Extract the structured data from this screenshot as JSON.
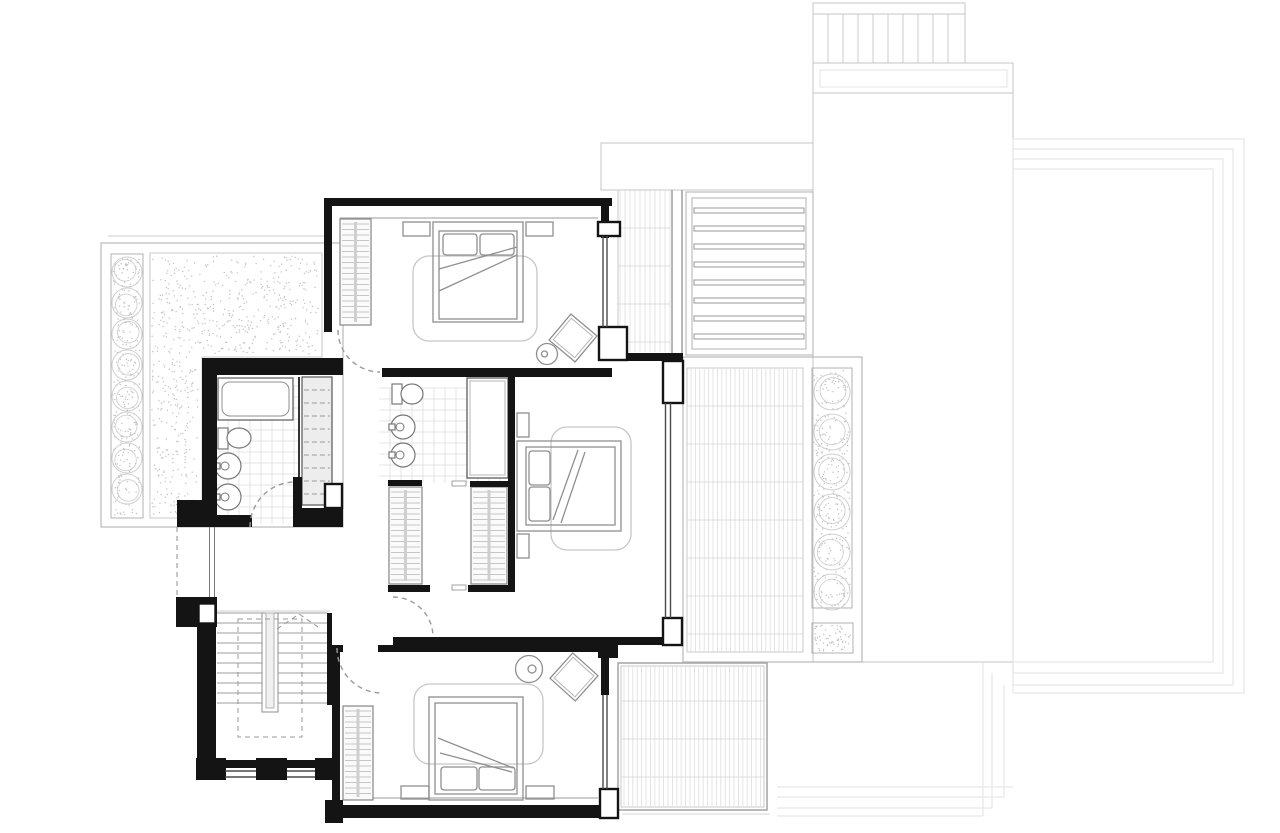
{
  "document": {
    "type": "architectural-floor-plan",
    "background": "#ffffff",
    "width": 1280,
    "height": 833
  },
  "palette": {
    "wall": "#141414",
    "pilaster_stroke": "#141414",
    "window": "#4a4a4a",
    "window_light": "#7a7a7a",
    "door_dash": "#9a9a9a",
    "furniture": "#8f8f8f",
    "furniture_inner": "#b5b5b5",
    "rug": "#c6c6c6",
    "ledge": "#9a9a9a",
    "hatch": "#b4b4b4",
    "spine": "#cfcfcf",
    "wardrobe_fill": "#fafafa",
    "cabinet_dash_fill": "#ededed",
    "tile_line": "#dedede",
    "tile_row": "#d4d4d4",
    "tile_border": "#a9a9a9",
    "tile_border_light": "#c9c9c9",
    "terrace_border": "#ababab",
    "outdoor": "#c6c6c6",
    "pool": "#e3e3e3",
    "stipple": "#c0c0c0",
    "bush": "#d0d0d0",
    "stair": "#9c9c9c",
    "stair_faint": "#cfcfcf",
    "beam": "#999999",
    "louver": "#b0b0b0"
  },
  "patterns": {
    "pergola_slats": 9,
    "pergola_slat_step": 15,
    "louver_slats": 8,
    "louver_slat_step": 18,
    "stair_treads": 10,
    "stair_tread_step": 10,
    "tile_step_fine": 4.4,
    "tile_step_strip": 5,
    "tile_row_step": 38,
    "bath_tile_step": 11,
    "wardrobe_hatch_step": 5.5,
    "cabinet_dash_step": 13,
    "bushes_left": 8,
    "bushes_right": 6,
    "pool_rings": 4,
    "dots_left_terrace": 430,
    "dots_left_side": 200,
    "dots_left_strip": 200,
    "dots_right_strip": 220,
    "dots_right_square": 60,
    "random_seed": 7
  },
  "components": {
    "rooms": [
      "bedroom-top",
      "master-suite",
      "ensuite-bathroom",
      "walk-in-closet",
      "bathroom",
      "hallway",
      "staircase",
      "bedroom-bottom"
    ],
    "outdoor": [
      "left-terrace",
      "right-terrace",
      "pool",
      "pool-deck",
      "pergola",
      "spa-bench",
      "louver-screen",
      "tiled-patio",
      "planting-strips"
    ],
    "furniture": [
      "double-bed",
      "nightstands",
      "rugs",
      "armchairs",
      "side-tables",
      "wardrobes",
      "bathtub",
      "toilets",
      "basins",
      "vanity-cabinet"
    ]
  }
}
